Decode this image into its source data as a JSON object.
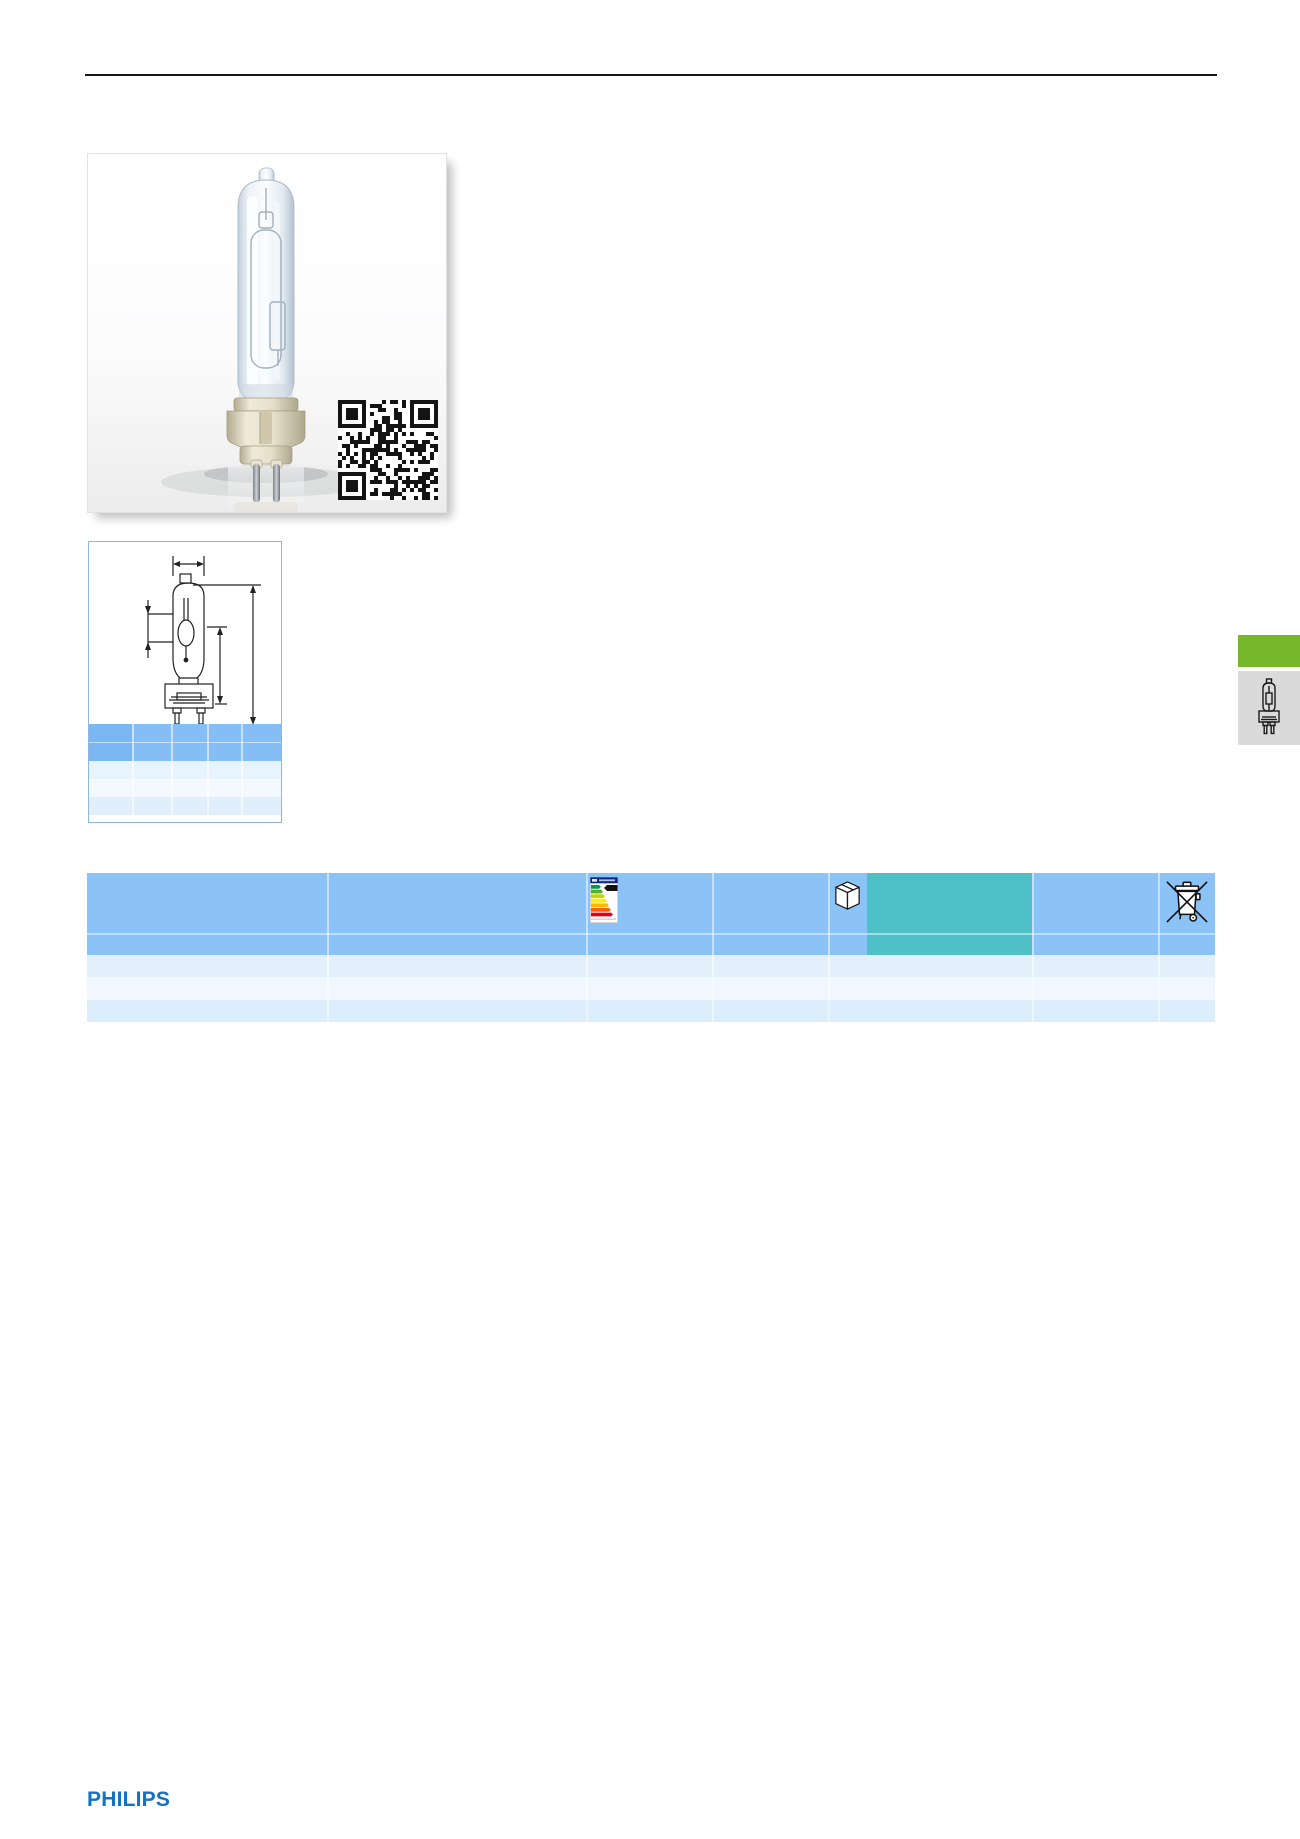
{
  "brand": {
    "logo_text": "PHILIPS"
  },
  "theme": {
    "header_blue": "#8BC3F7",
    "teal_cell": "#4FC1C6",
    "row_light": "#E3F0FC",
    "row_lighter": "#F0F7FE",
    "row_light2": "#DCEDFB",
    "dim_header_blue": "#85BEF5",
    "dim_header_first_col": "#7AB7F3",
    "green_tab": "#77B82A",
    "tab_gray": "#DADADA",
    "philips_blue": "#1173C6"
  },
  "photo_box": {
    "subject": "single-ended metal halide lamp with ceramic G12 base",
    "qr_code": "qr-code"
  },
  "dimension_box": {
    "drawing": "lamp-outline-with-dimension-arrows",
    "table_columns": 5,
    "table_body_rows": 3,
    "cells_text": ""
  },
  "main_table": {
    "header_rows": 2,
    "body_rows": 3,
    "cells_text": "",
    "icons": [
      "energy-label-icon",
      "package-box-icon",
      "weee-crossed-bin-icon"
    ]
  },
  "side_tabs": {
    "green_tab_label": "",
    "gray_tab_icon": "lamp-outline-icon"
  }
}
